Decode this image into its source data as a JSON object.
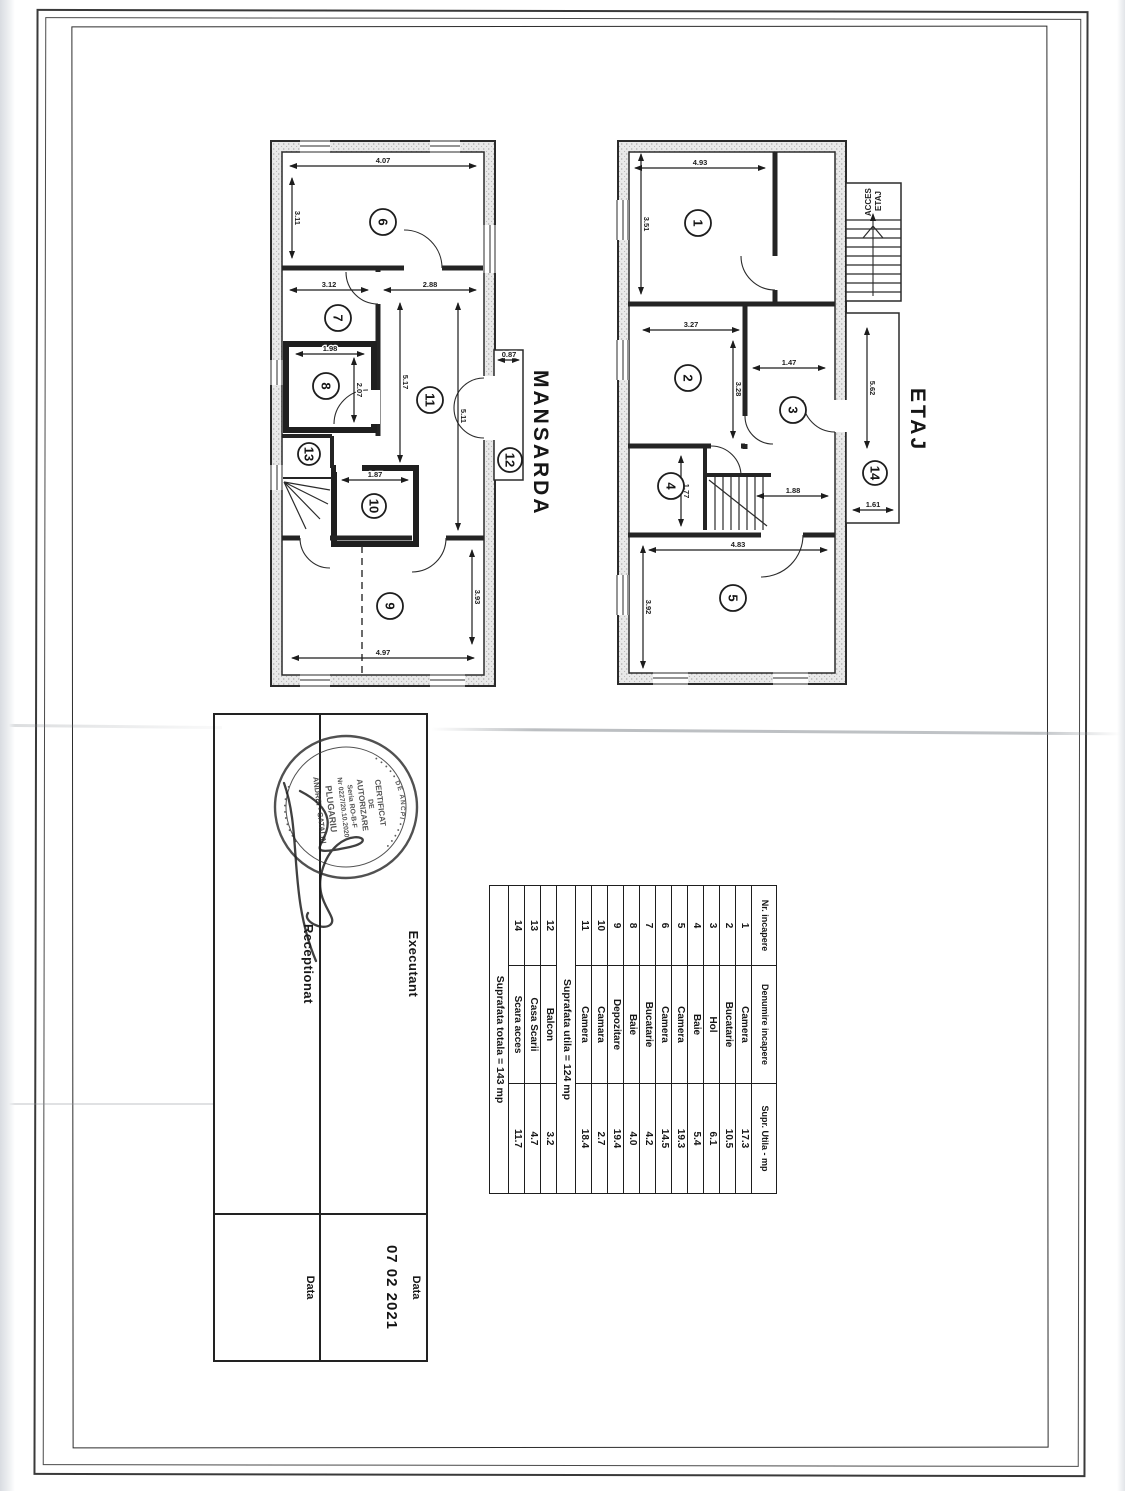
{
  "plans": {
    "etaj": {
      "label": "ETAJ",
      "access_stairs_label": [
        "ACCES",
        "ETAJ"
      ],
      "rooms": [
        "1",
        "2",
        "3",
        "4",
        "5",
        "14"
      ],
      "dims": [
        "4.93",
        "3.51",
        "3.27",
        "3.28",
        "1.47",
        "3.92",
        "4.83",
        "5.62",
        "1.61",
        "1.77",
        "1.88"
      ]
    },
    "mansarda": {
      "label": "MANSARDA",
      "rooms": [
        "6",
        "7",
        "8",
        "9",
        "10",
        "11",
        "12",
        "13"
      ],
      "dims": [
        "4.07",
        "3.11",
        "3.12",
        "2.88",
        "5.17",
        "5.11",
        "1.98",
        "2.07",
        "4.97",
        "3.93",
        "1.87",
        "0.87"
      ]
    }
  },
  "room_table": {
    "headers": [
      "Nr. incapere",
      "Denumire incapere",
      "Supr. Utila - mp"
    ],
    "rows": [
      [
        "1",
        "Camera",
        "17.3"
      ],
      [
        "2",
        "Bucatarie",
        "10.5"
      ],
      [
        "3",
        "Hol",
        "6.1"
      ],
      [
        "4",
        "Baie",
        "5.4"
      ],
      [
        "5",
        "Camera",
        "19.3"
      ],
      [
        "6",
        "Camera",
        "14.5"
      ],
      [
        "7",
        "Bucatarie",
        "4.2"
      ],
      [
        "8",
        "Baie",
        "4.0"
      ],
      [
        "9",
        "Depozitare",
        "19.4"
      ],
      [
        "10",
        "Camara",
        "2.7"
      ],
      [
        "11",
        "Camera",
        "18.4"
      ]
    ],
    "subtotal": "Suprafata utila = 124 mp",
    "rows_annex": [
      [
        "12",
        "Balcon",
        "3.2"
      ],
      [
        "13",
        "Casa Scarii",
        "4.7"
      ],
      [
        "14",
        "Scara acces",
        "11.7"
      ]
    ],
    "total": "Suprafata totala = 143 mp"
  },
  "title_block": {
    "executant_label": "Executant",
    "receptionat_label": "Receptionat",
    "data_label": "Data",
    "data_value": "07 02 2021"
  },
  "stamp": {
    "ring_top": "• • • • •  DE ANCPI  • • • • •",
    "ring_bottom": "• • • • • • • • • •",
    "lines": [
      "CERTIFICAT",
      "DE",
      "AUTORIZARE",
      "Seria RO-B-F",
      "Nr 0227/20.10.2020",
      "PLUGARIU",
      "ANDREI - CATALIN"
    ]
  }
}
